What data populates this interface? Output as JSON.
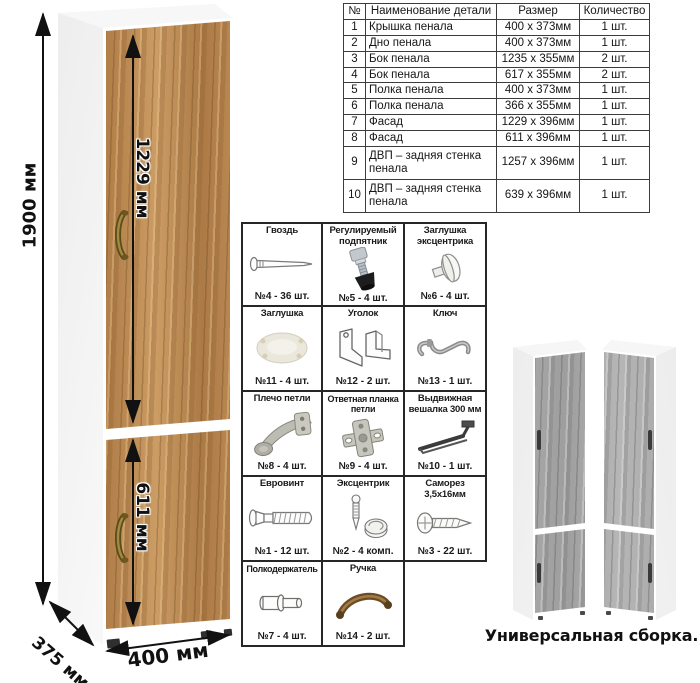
{
  "parts_table": {
    "headers": [
      "№",
      "Наименование детали",
      "Размер",
      "Количество"
    ],
    "rows": [
      {
        "num": "1",
        "name": "Крышка пенала",
        "size": "400 х 373мм",
        "qty": "1 шт."
      },
      {
        "num": "2",
        "name": "Дно пенала",
        "size": "400 х 373мм",
        "qty": "1 шт."
      },
      {
        "num": "3",
        "name": "Бок пенала",
        "size": "1235 х 355мм",
        "qty": "2 шт."
      },
      {
        "num": "4",
        "name": "Бок пенала",
        "size": "617 х 355мм",
        "qty": "2 шт."
      },
      {
        "num": "5",
        "name": "Полка пенала",
        "size": "400 х 373мм",
        "qty": "1 шт."
      },
      {
        "num": "6",
        "name": "Полка пенала",
        "size": "366 х 355мм",
        "qty": "1 шт."
      },
      {
        "num": "7",
        "name": "Фасад",
        "size": "1229 х 396мм",
        "qty": "1 шт."
      },
      {
        "num": "8",
        "name": "Фасад",
        "size": "611 х 396мм",
        "qty": "1 шт."
      },
      {
        "num": "9",
        "name": "ДВП – задняя стенка пенала",
        "size": "1257 х 396мм",
        "qty": "1 шт."
      },
      {
        "num": "10",
        "name": "ДВП – задняя стенка пенала",
        "size": "639 х 396мм",
        "qty": "1 шт."
      }
    ]
  },
  "hardware_grid": {
    "items": [
      {
        "title": "Гвоздь",
        "count": "№4 - 36 шт.",
        "icon": "nail-icon"
      },
      {
        "title": "Регулируемый подпятник",
        "count": "№5 - 4 шт.",
        "icon": "adjustable-foot-icon"
      },
      {
        "title": "Заглушка эксцентрика",
        "count": "№6 - 4 шт.",
        "icon": "cam-cover-icon"
      },
      {
        "title": "Заглушка",
        "count": "№11 - 4 шт.",
        "icon": "plug-icon"
      },
      {
        "title": "Уголок",
        "count": "№12 - 2 шт.",
        "icon": "corner-bracket-icon"
      },
      {
        "title": "Ключ",
        "count": "№13 - 1 шт.",
        "icon": "key-icon"
      },
      {
        "title": "Плечо петли",
        "count": "№8 - 4 шт.",
        "icon": "hinge-arm-icon"
      },
      {
        "title": "Ответная планка петли",
        "count": "№9 - 4 шт.",
        "icon": "hinge-plate-icon"
      },
      {
        "title": "Выдвижная вешалка 300 мм",
        "count": "№10 - 1 шт.",
        "icon": "pullout-hanger-icon"
      },
      {
        "title": "Евровинт",
        "count": "№1 - 12 шт.",
        "icon": "euro-screw-icon"
      },
      {
        "title": "Эксцентрик",
        "count": "№2 - 4 комп.",
        "icon": "cam-lock-icon"
      },
      {
        "title": "Саморез 3,5х16мм",
        "count": "№3 - 22 шт.",
        "icon": "self-tapping-screw-icon"
      },
      {
        "title": "Полкодержатель",
        "count": "№7 - 4 шт.",
        "icon": "shelf-pin-icon"
      },
      {
        "title": "Ручка",
        "count": "№14 - 2 шт.",
        "icon": "handle-icon"
      }
    ]
  },
  "cabinet_dimensions": {
    "height": "1900 мм",
    "upper_door": "1229 мм",
    "lower_door": "611 мм",
    "width": "400 мм",
    "depth": "375 мм"
  },
  "caption": "Универсальная сборка.",
  "colors": {
    "wood_base": "#bc8a52",
    "gray_wood_base": "#a6a6a6",
    "handle_bronze": "#6e4f26",
    "dimension_line": "#111111",
    "table_border": "#3c3c3c"
  }
}
